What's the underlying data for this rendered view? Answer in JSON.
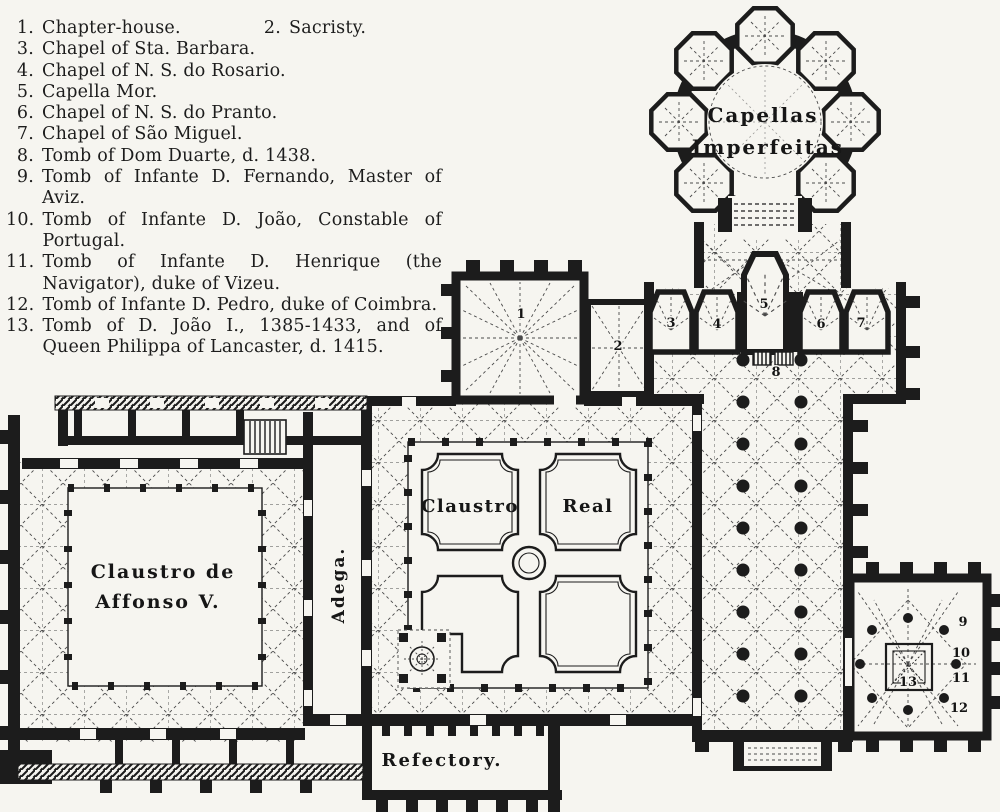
{
  "colors": {
    "paper": "#f6f5f0",
    "ink": "#1c1c1c"
  },
  "legend": {
    "items": [
      {
        "num": "1.",
        "text": "Chapter-house."
      },
      {
        "num": "2.",
        "text": "Sacristy."
      },
      {
        "num": "3.",
        "text": "Chapel of Sta. Barbara."
      },
      {
        "num": "4.",
        "text": "Chapel of N. S. do Rosario."
      },
      {
        "num": "5.",
        "text": "Capella Mor."
      },
      {
        "num": "6.",
        "text": "Chapel of N. S. do Pranto."
      },
      {
        "num": "7.",
        "text": "Chapel of São Miguel."
      },
      {
        "num": "8.",
        "text": "Tomb of Dom Duarte, d. 1438."
      },
      {
        "num": "9.",
        "text": "Tomb of Infante D. Fernando, Master of Aviz."
      },
      {
        "num": "10.",
        "text": "Tomb of Infante D. João, Constable of Portugal."
      },
      {
        "num": "11.",
        "text": "Tomb of Infante D. Henrique (the Navigator), duke of Vizeu."
      },
      {
        "num": "12.",
        "text": "Tomb of Infante D. Pedro, duke of Coimbra."
      },
      {
        "num": "13.",
        "text": "Tomb of D. João I., 1385-1433, and of Queen Philippa of Lancaster, d. 1415."
      }
    ]
  },
  "plan": {
    "labels": {
      "capellas_line1": "Capellas",
      "capellas_line2": "Imperfeitas",
      "claustro_real_left": "Claustro",
      "claustro_real_right": "Real",
      "affonso_line1": "Claustro  de",
      "affonso_line2": "Affonso  V.",
      "adega": "Adega.",
      "refectory": "Refectory."
    },
    "markers": {
      "n1": "1",
      "n2": "2",
      "n3": "3",
      "n4": "4",
      "n5": "5",
      "n6": "6",
      "n7": "7",
      "n8": "8",
      "n9": "9",
      "n10": "10",
      "n11": "11",
      "n12": "12",
      "n13": "13"
    }
  }
}
